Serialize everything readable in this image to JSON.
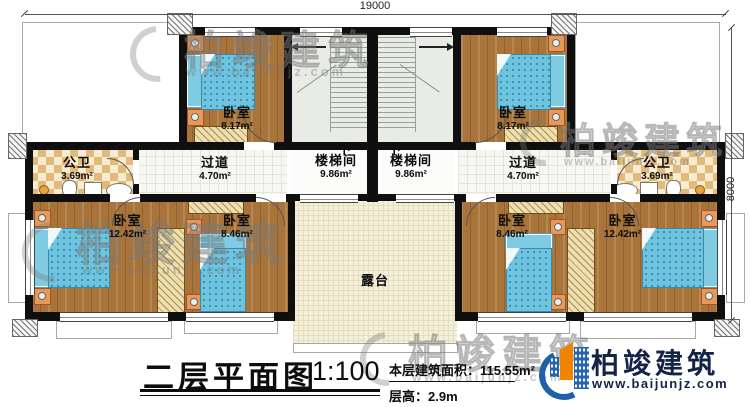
{
  "plan": {
    "dimension_top": "19000",
    "dimension_right": "8000",
    "rooms": {
      "bedroom_top_left": {
        "name": "卧室",
        "area": "8.17m²"
      },
      "bedroom_top_right": {
        "name": "卧室",
        "area": "8.17m²"
      },
      "bath_left": {
        "name": "公卫",
        "area": "3.69m²"
      },
      "bath_right": {
        "name": "公卫",
        "area": "3.69m²"
      },
      "corridor_left": {
        "name": "过道",
        "area": "4.70m²"
      },
      "corridor_right": {
        "name": "过道",
        "area": "4.70m²"
      },
      "stairwell_left": {
        "name": "楼梯间",
        "area": "9.86m²",
        "down_label": "下"
      },
      "stairwell_right": {
        "name": "楼梯间",
        "area": "9.86m²",
        "down_label": "下"
      },
      "bedroom_bottom_left_large": {
        "name": "卧室",
        "area": "12.42m²"
      },
      "bedroom_bottom_left_small": {
        "name": "卧室",
        "area": "8.46m²"
      },
      "bedroom_bottom_right_small": {
        "name": "卧室",
        "area": "8.46m²"
      },
      "bedroom_bottom_right_large": {
        "name": "卧室",
        "area": "12.42m²"
      },
      "terrace": {
        "name": "露台"
      }
    }
  },
  "title_block": {
    "title": "二层平面图",
    "scale": "1:100",
    "floor_area": "本层建筑面积：115.55m²",
    "floor_height": "层高：2.9m"
  },
  "logo": {
    "name": "柏竣建筑",
    "website": "www.baijunjz.com"
  },
  "watermark": {
    "text": "柏竣建筑",
    "website": "www.baijunjz.com"
  },
  "colors": {
    "wall": "#0f0f0f",
    "wood_floor": "#a9743a",
    "bath_tile": "#e2ba79",
    "terrace_floor": "#f4f0da",
    "stair_floor": "#e8ece4",
    "bed_blue": "#6fc3de",
    "nightstand_orange": "#e59a58",
    "logo_navy": "#132347",
    "logo_blue": "#2565ae",
    "logo_orange": "#f08300"
  }
}
